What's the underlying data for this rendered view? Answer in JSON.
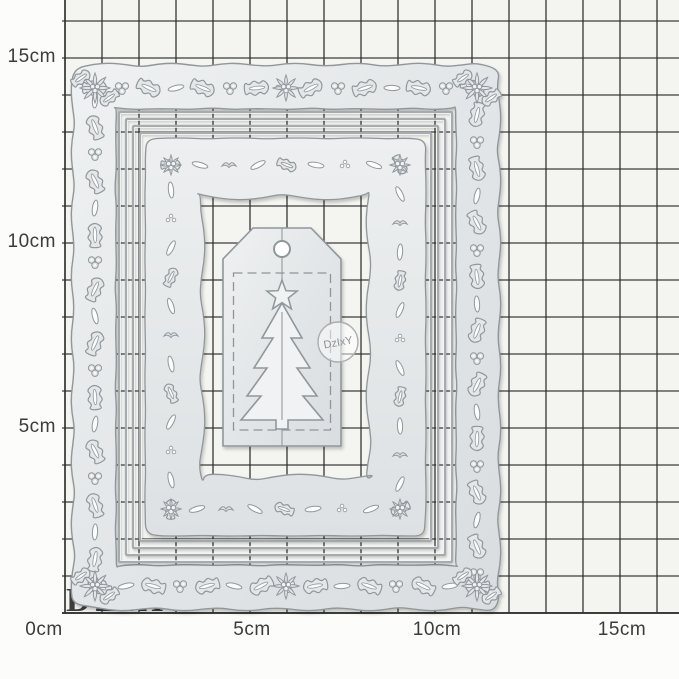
{
  "page": {
    "background": "#fcfcfb"
  },
  "mat": {
    "color": "#f4f4f1",
    "grid_color": "#2e2e2c",
    "cm_px": 37,
    "origin_x": 65,
    "origin_y": 613,
    "max_cm": 16,
    "watermark": "DZIXY",
    "watermark_color": "#2f2f2f"
  },
  "ruler_labels": {
    "left": [
      {
        "text": "15cm",
        "cm": 15
      },
      {
        "text": "10cm",
        "cm": 10
      },
      {
        "text": "5cm",
        "cm": 5
      }
    ],
    "bottom": [
      {
        "text": "0cm",
        "cm": 0
      },
      {
        "text": "5cm",
        "cm": 5
      },
      {
        "text": "10cm",
        "cm": 10
      },
      {
        "text": "15cm",
        "cm": 15
      }
    ]
  },
  "die_set": {
    "metal": "#e4e7e9",
    "metal_light": "#f0f2f3",
    "outline": "#90979b",
    "slot": "#fbfcfb",
    "rect_stroke": "#a5abaf",
    "components": [
      "outer-holly-frame-die",
      "nested-rectangle-dies",
      "inner-leaf-border-die",
      "gift-tag-die",
      "christmas-tree-die",
      "star-die"
    ]
  },
  "badge": {
    "text": "DzIxY",
    "border": "#a9aeb2",
    "text_color": "#8d9398"
  }
}
